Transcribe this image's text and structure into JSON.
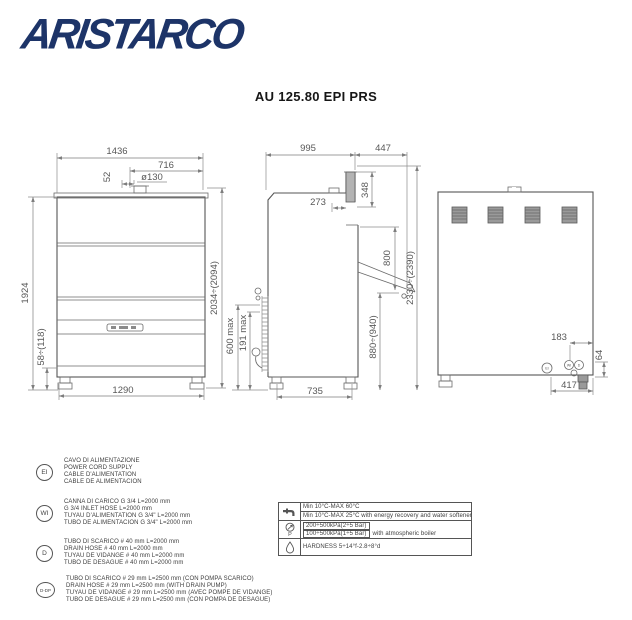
{
  "brand": {
    "logo_text": "ARISTARCO",
    "logo_color": "#1d3468"
  },
  "header": {
    "title": "AU 125.80 EPI PRS"
  },
  "drawing": {
    "front": {
      "width": "1436",
      "hood_width": "716",
      "offset": "52",
      "drain_hole": "ø130",
      "height": "1924",
      "open_height": "2034÷(2094)",
      "plinth": "58÷(118)",
      "feet_span": "1290"
    },
    "side": {
      "depth": "995",
      "open_depth": "447",
      "duct": "348",
      "duct_offset": "273",
      "opening": "800",
      "total_height": "2330÷(2390)",
      "table_height": "880÷(940)",
      "drain_max": "600 max",
      "drain_min": "191 max",
      "feet_span": "735"
    },
    "rear": {
      "conn_inset": "183",
      "conn_height": "64",
      "conn_span": "417",
      "marker1": "EI",
      "marker2": "WI",
      "marker3": "D"
    }
  },
  "legend": {
    "items": [
      {
        "symbol": "EI",
        "lines": [
          "CAVO DI ALIMENTAZIONE",
          "POWER CORD SUPPLY",
          "CABLE D'ALIMENTATION",
          "CABLE DE ALIMENTACION"
        ]
      },
      {
        "symbol": "WI",
        "lines": [
          "CANNA DI CARICO G 3/4 L=2000 mm",
          "G 3/4 INLET HOSE L=2000 mm",
          "TUYAU D'ALIMENTATION G 3/4\" L=2000 mm",
          "TUBO DE ALIMENTACION G 3/4\" L=2000 mm"
        ]
      },
      {
        "symbol": "D",
        "lines": [
          "TUBO DI SCARICO # 40 mm L=2000 mm",
          "DRAIN HOSE # 40 mm L=2000 mm",
          "TUYAU DE VIDANGE # 40 mm L=2000 mm",
          "TUBO DE DESAGUE # 40 mm L=2000 mm"
        ]
      },
      {
        "symbol": "D-DP",
        "lines": [
          "TUBO DI SCARICO # 29 mm L=2500 mm (CON POMPA SCARICO)",
          "DRAIN HOSE # 29 mm L=2500 mm (WITH DRAIN PUMP)",
          "TUYAU DE VIDANGE # 29 mm L=2500 mm (AVEC POMPE DE VIDANGE)",
          "TUBO DE DESAGUE # 29 mm L=2500 mm (CON POMPA DE DESAGUE)"
        ]
      }
    ]
  },
  "spec_table": {
    "rows": [
      {
        "icon": "water-tap-icon",
        "cells": [
          {
            "text": "Min 10°C-MAX 60°C"
          },
          {
            "text": "Min 10°C-MAX 25°C  with energy recovery and water softener"
          }
        ]
      },
      {
        "icon": "pressure-gauge-icon",
        "icon_letter": "P",
        "cells": [
          {
            "text": "200÷500kPa(2÷5 Bar)",
            "suffix": ""
          },
          {
            "text": "100÷500kPa(1÷5 Bar)",
            "suffix": "with atmospheric boiler"
          }
        ]
      },
      {
        "icon": "water-drop-icon",
        "cells": [
          {
            "text": "HARDNESS 5÷14°f-2.8÷8°d"
          }
        ]
      }
    ]
  }
}
